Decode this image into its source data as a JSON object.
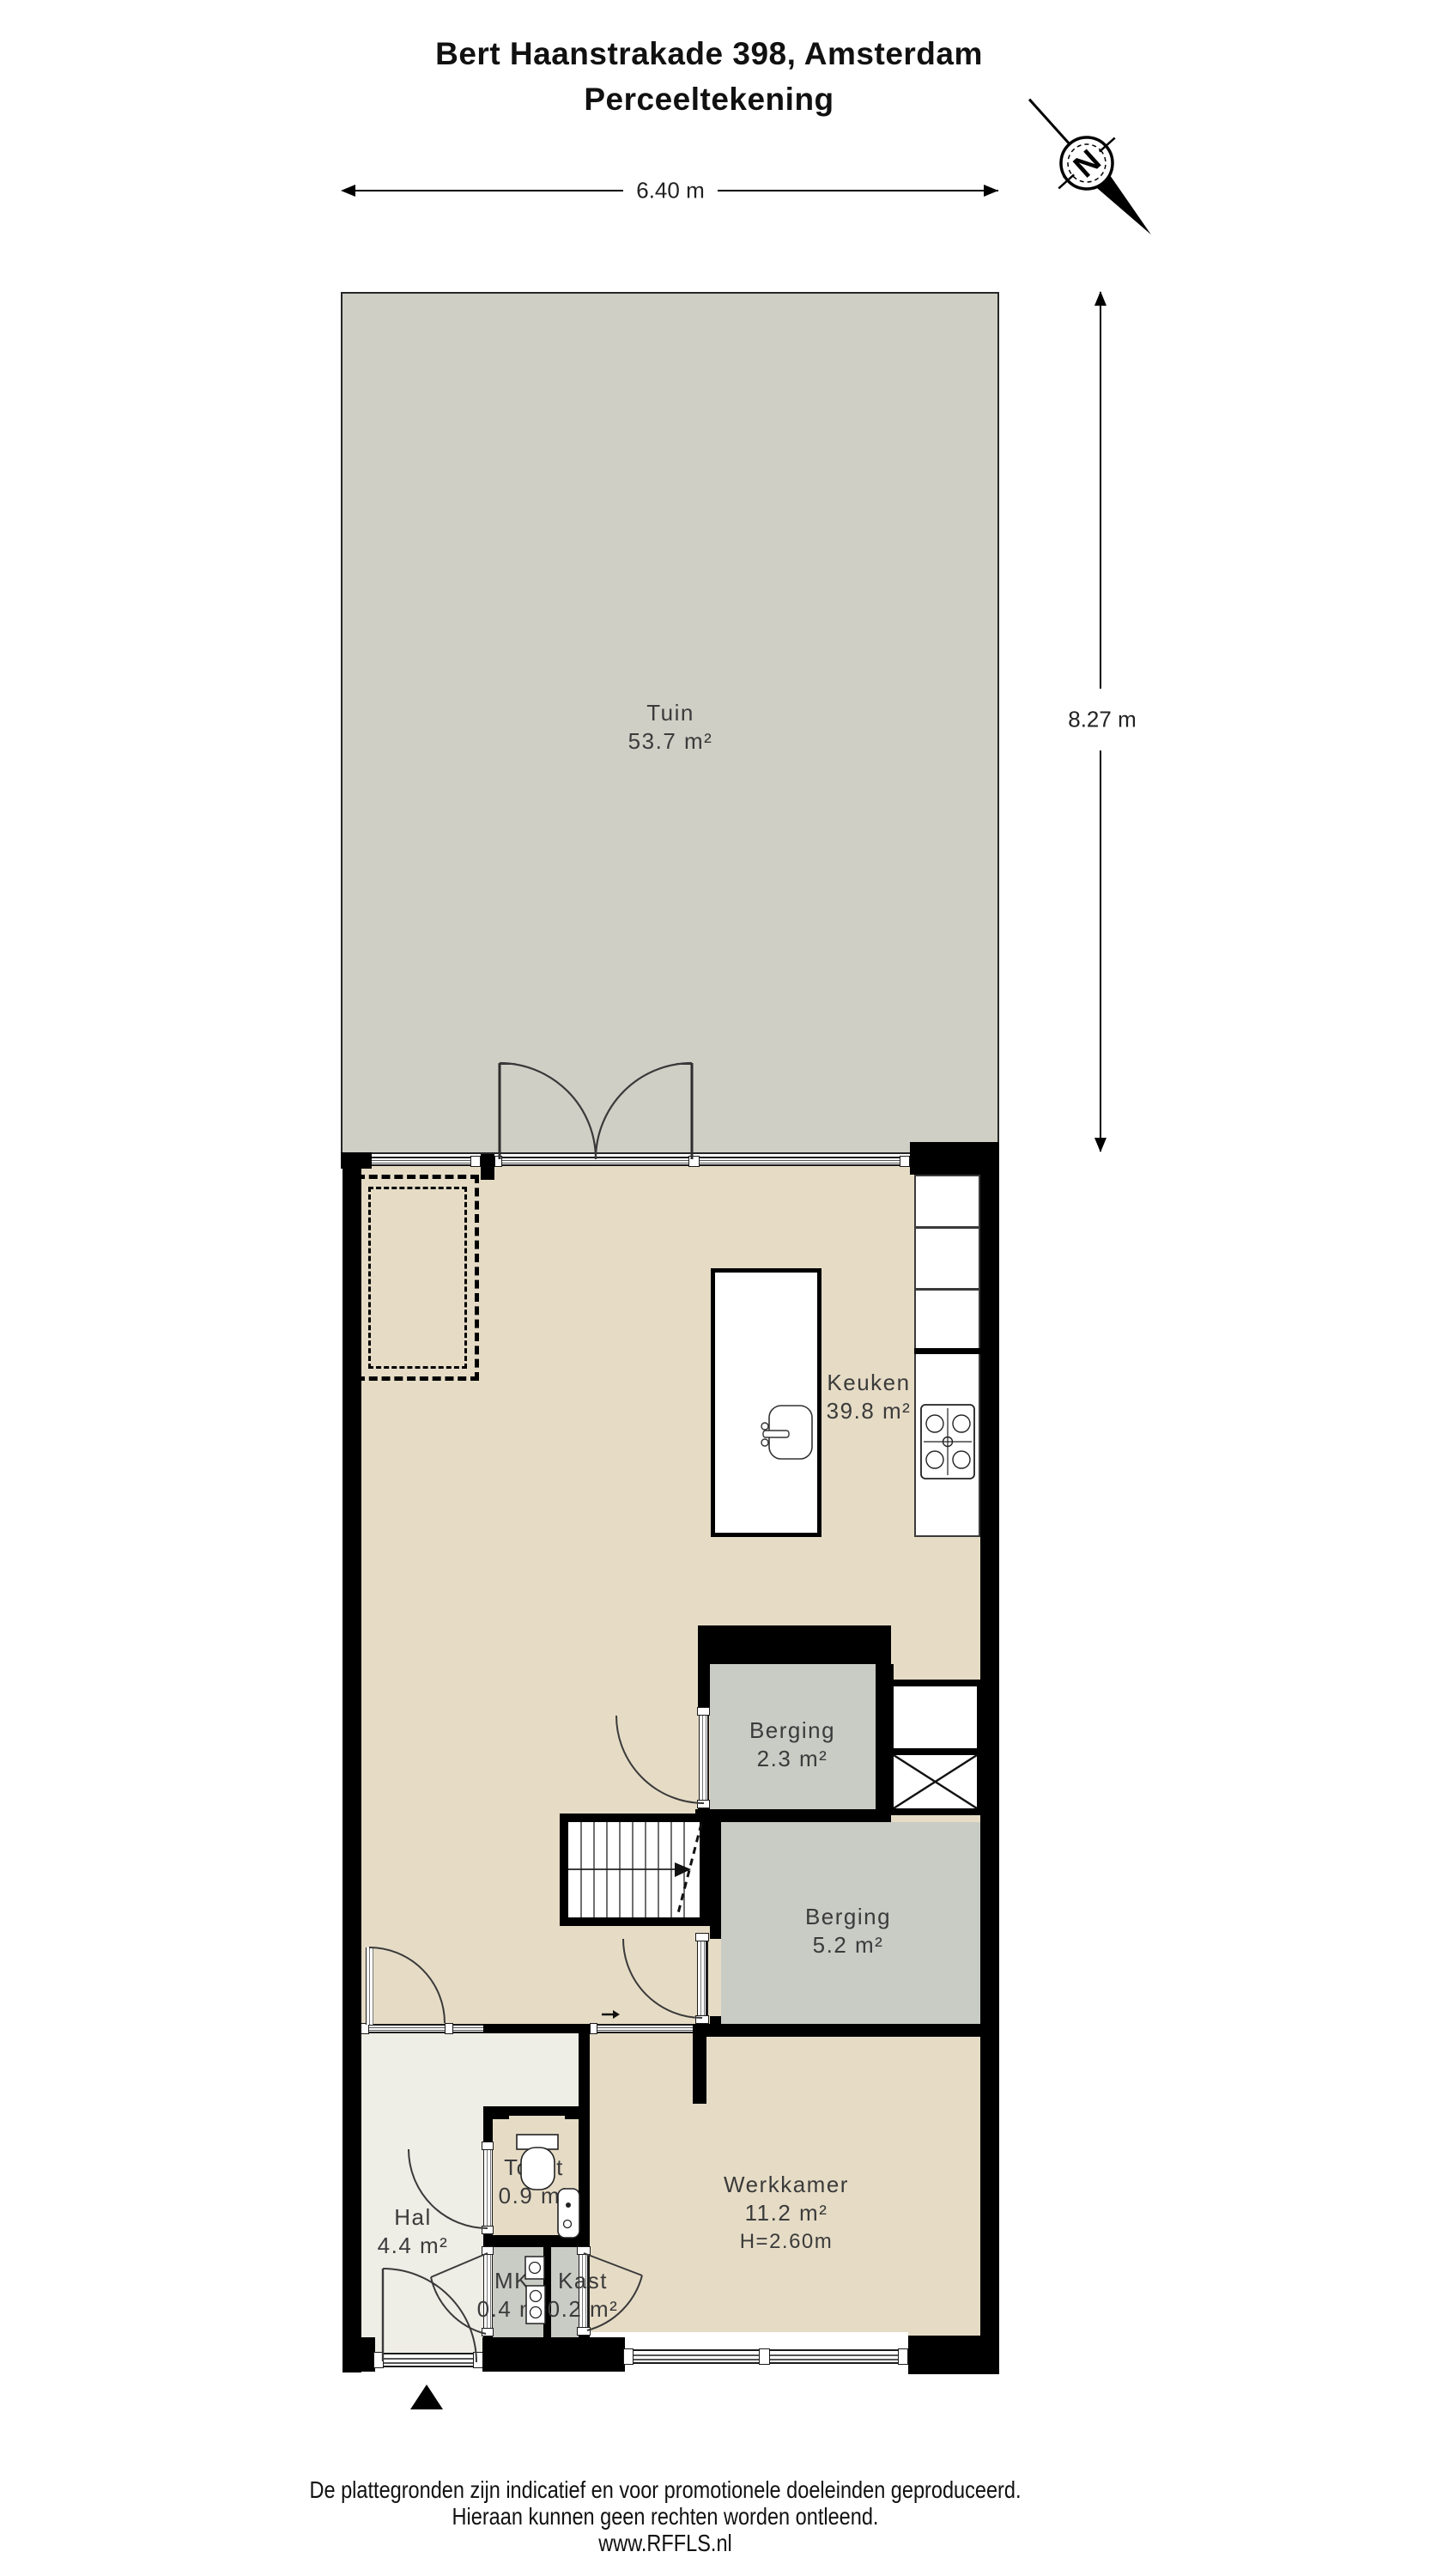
{
  "title": {
    "line1": "Bert Haanstrakade 398, Amsterdam",
    "line2": "Perceeltekening"
  },
  "dimensions": {
    "width_label": "6.40 m",
    "height_label": "8.27 m"
  },
  "compass": {
    "north_label": "N"
  },
  "rooms": {
    "tuin": {
      "name": "Tuin",
      "area": "53.7 m²"
    },
    "keuken": {
      "name": "Keuken",
      "area": "39.8 m²"
    },
    "berging_klein": {
      "name": "Berging",
      "area": "2.3 m²"
    },
    "berging_groot": {
      "name": "Berging",
      "area": "5.2 m²"
    },
    "hal": {
      "name": "Hal",
      "area": "4.4 m²"
    },
    "toilet": {
      "name": "Toilet",
      "area": "0.9 m²"
    },
    "mk": {
      "name": "MK",
      "area": "0.4 m²"
    },
    "kast": {
      "name": "Kast",
      "area": "0.2 m²"
    },
    "werkkamer": {
      "name": "Werkkamer",
      "area": "11.2 m²",
      "ceiling_height": "H=2.60m"
    }
  },
  "footer": {
    "line1": "De plattegronden zijn indicatief en voor promotionele doeleinden geproduceerd.",
    "line2": "Hieraan kunnen geen rechten worden ontleend.",
    "line3": "www.RFFLS.nl"
  },
  "colors": {
    "wall": "#000000",
    "garden": "#d0cfc6",
    "beige": "#e6dcc6",
    "gray": "#c9cbc5",
    "light": "#eeede6",
    "label": "#3b3b3b"
  }
}
